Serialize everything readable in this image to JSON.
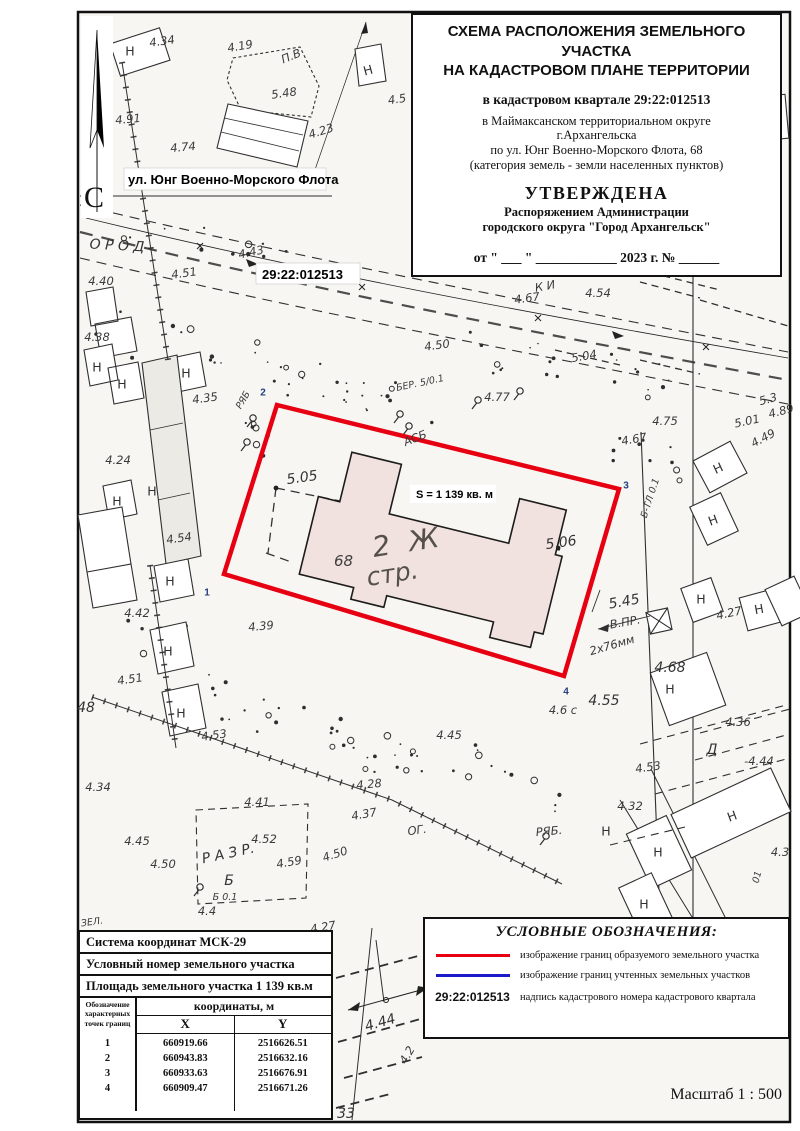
{
  "title_block": {
    "head1": "СХЕМА РАСПОЛОЖЕНИЯ ЗЕМЕЛЬНОГО УЧАСТКА",
    "head2": "НА КАДАСТРОВОМ ПЛАНЕ ТЕРРИТОРИИ",
    "quarter": "в кадастровом квартале 29:22:012513",
    "addr1": "в Маймаксанском территориальном округе",
    "addr2": "г.Архангельска",
    "addr3": "по ул. Юнг Военно-Морского Флота, 68",
    "addr4": "(категория земель - земли населенных пунктов)",
    "approved": "УТВЕРЖДЕНА",
    "admin1": "Распоряжением Администрации",
    "admin2": "городского округа \"Город Архангельск\"",
    "date_line": "от \" ___ \" ____________ 2023 г. № ______"
  },
  "map": {
    "north_label": "С",
    "street_label": "ул. Юнг Военно-Морского Флота",
    "quarter_label": "29:22:012513",
    "area_label": "S = 1 139 кв. м",
    "building_label_line1": "2 Ж",
    "building_label_line2": "стр.",
    "building_number": "68",
    "colors": {
      "parcel_formed": "#e60012",
      "building_fill": "#f1e2df"
    },
    "labels": [
      {
        "t": "Н",
        "x": 130,
        "y": 51,
        "c": "n"
      },
      {
        "t": "4.34",
        "x": 162,
        "y": 41,
        "r": -8
      },
      {
        "t": "4.19",
        "x": 240,
        "y": 46,
        "r": -10
      },
      {
        "t": "П.В",
        "x": 291,
        "y": 56,
        "r": -22
      },
      {
        "t": "5.48",
        "x": 284,
        "y": 93,
        "r": -8
      },
      {
        "t": "Н",
        "x": 368,
        "y": 70,
        "c": "n",
        "r": -15
      },
      {
        "t": "4.5",
        "x": 397,
        "y": 99,
        "r": -8
      },
      {
        "t": "4.91",
        "x": 128,
        "y": 119,
        "r": -5
      },
      {
        "t": "4.74",
        "x": 183,
        "y": 147,
        "r": -5
      },
      {
        "t": "4.23",
        "x": 321,
        "y": 131,
        "r": -18
      },
      {
        "t": "О Р О Д",
        "x": 117,
        "y": 245,
        "c": "hw2",
        "r": 3
      },
      {
        "t": "4.43",
        "x": 251,
        "y": 252,
        "r": -12
      },
      {
        "t": "4.51",
        "x": 184,
        "y": 273,
        "r": -8
      },
      {
        "t": "4.40",
        "x": 101,
        "y": 281
      },
      {
        "t": "4.67",
        "x": 527,
        "y": 298,
        "r": -8
      },
      {
        "t": "К И",
        "x": 545,
        "y": 286,
        "r": -10
      },
      {
        "t": "4.54",
        "x": 598,
        "y": 293
      },
      {
        "t": "4.38",
        "x": 97,
        "y": 337
      },
      {
        "t": "4.50",
        "x": 437,
        "y": 345,
        "r": -8
      },
      {
        "t": "5.04",
        "x": 584,
        "y": 356,
        "r": -10
      },
      {
        "t": "БЕР. 5/0.1",
        "x": 420,
        "y": 383,
        "r": -12,
        "c": "sm"
      },
      {
        "t": "4.35",
        "x": 205,
        "y": 398,
        "r": -8
      },
      {
        "t": "РЯБ",
        "x": 243,
        "y": 400,
        "c": "sm",
        "r": -60
      },
      {
        "t": "4.77",
        "x": 497,
        "y": 397
      },
      {
        "t": "АСБ",
        "x": 415,
        "y": 438,
        "r": -22
      },
      {
        "t": "4.75",
        "x": 665,
        "y": 421
      },
      {
        "t": "4.67",
        "x": 634,
        "y": 439,
        "r": -10
      },
      {
        "t": "5.01",
        "x": 747,
        "y": 421,
        "r": -12
      },
      {
        "t": "4.49",
        "x": 763,
        "y": 438,
        "r": -28
      },
      {
        "t": "5.3",
        "x": 768,
        "y": 399,
        "r": -15
      },
      {
        "t": "4.89",
        "x": 781,
        "y": 411,
        "r": -15
      },
      {
        "t": "4.24",
        "x": 118,
        "y": 460
      },
      {
        "t": "Н",
        "x": 97,
        "y": 367,
        "c": "n"
      },
      {
        "t": "Н",
        "x": 122,
        "y": 384,
        "c": "n"
      },
      {
        "t": "Н",
        "x": 186,
        "y": 373,
        "c": "n"
      },
      {
        "t": "Б-ТЛ 0.1",
        "x": 650,
        "y": 498,
        "r": -72,
        "c": "sm"
      },
      {
        "t": "Н",
        "x": 718,
        "y": 468,
        "c": "n",
        "r": -25
      },
      {
        "t": "Н",
        "x": 713,
        "y": 520,
        "c": "n",
        "r": -20
      },
      {
        "t": "5.05",
        "x": 302,
        "y": 477,
        "c": "hw2",
        "r": -8
      },
      {
        "t": "5.06",
        "x": 561,
        "y": 542,
        "c": "hw2",
        "r": -8
      },
      {
        "t": "Н",
        "x": 152,
        "y": 491,
        "c": "n"
      },
      {
        "t": "Н",
        "x": 117,
        "y": 501,
        "c": "n"
      },
      {
        "t": "4.54",
        "x": 179,
        "y": 538,
        "r": -8
      },
      {
        "t": "4.42",
        "x": 137,
        "y": 613
      },
      {
        "t": "4.39",
        "x": 261,
        "y": 626,
        "r": -5
      },
      {
        "t": "Н",
        "x": 170,
        "y": 581,
        "c": "n"
      },
      {
        "t": "Н",
        "x": 168,
        "y": 651,
        "c": "n"
      },
      {
        "t": "4.51",
        "x": 130,
        "y": 679,
        "r": -8
      },
      {
        "t": "48",
        "x": 86,
        "y": 707,
        "c": "hw2"
      },
      {
        "t": "Н",
        "x": 181,
        "y": 713,
        "c": "n"
      },
      {
        "t": "4.53",
        "x": 214,
        "y": 735,
        "r": -8
      },
      {
        "t": "5.45",
        "x": 624,
        "y": 601,
        "c": "hw2",
        "r": -10
      },
      {
        "t": "В.ПР.",
        "x": 625,
        "y": 622,
        "r": -10
      },
      {
        "t": "2х76мм",
        "x": 612,
        "y": 645,
        "r": -16
      },
      {
        "t": "4.68",
        "x": 670,
        "y": 667,
        "c": "hw2"
      },
      {
        "t": "4.27",
        "x": 729,
        "y": 613,
        "r": -12
      },
      {
        "t": "Н",
        "x": 701,
        "y": 599,
        "c": "n"
      },
      {
        "t": "Н",
        "x": 759,
        "y": 609,
        "c": "n",
        "r": -10
      },
      {
        "t": "Н",
        "x": 670,
        "y": 689,
        "c": "n"
      },
      {
        "t": "4.55",
        "x": 604,
        "y": 700,
        "c": "hw2"
      },
      {
        "t": "4.6 с",
        "x": 563,
        "y": 710
      },
      {
        "t": "4.45",
        "x": 449,
        "y": 735
      },
      {
        "t": "4.36",
        "x": 738,
        "y": 722
      },
      {
        "t": "Д",
        "x": 712,
        "y": 749,
        "c": "hw2"
      },
      {
        "t": "-4.44",
        "x": 759,
        "y": 761
      },
      {
        "t": "4.53",
        "x": 648,
        "y": 767,
        "r": -8
      },
      {
        "t": "4.32",
        "x": 630,
        "y": 806
      },
      {
        "t": "4.28",
        "x": 369,
        "y": 784,
        "r": -5
      },
      {
        "t": "4.37",
        "x": 364,
        "y": 814,
        "r": -10
      },
      {
        "t": "4.41",
        "x": 257,
        "y": 802
      },
      {
        "t": "4.34",
        "x": 98,
        "y": 787
      },
      {
        "t": "ОГ.",
        "x": 417,
        "y": 830,
        "r": -8
      },
      {
        "t": "РЯБ.",
        "x": 549,
        "y": 831,
        "r": -5
      },
      {
        "t": "Н",
        "x": 606,
        "y": 831,
        "c": "n"
      },
      {
        "t": "Н",
        "x": 732,
        "y": 816,
        "c": "n",
        "r": -20
      },
      {
        "t": "Н",
        "x": 658,
        "y": 852,
        "c": "n"
      },
      {
        "t": "Н",
        "x": 644,
        "y": 904,
        "c": "n"
      },
      {
        "t": "01",
        "x": 757,
        "y": 877,
        "r": -75,
        "c": "sm"
      },
      {
        "t": "4.3",
        "x": 780,
        "y": 852
      },
      {
        "t": "4.45",
        "x": 137,
        "y": 841
      },
      {
        "t": "4.50",
        "x": 163,
        "y": 864
      },
      {
        "t": "Р А З Р.",
        "x": 228,
        "y": 853,
        "r": -12,
        "c": "hw2"
      },
      {
        "t": "4.52",
        "x": 264,
        "y": 839
      },
      {
        "t": "4.59",
        "x": 289,
        "y": 862,
        "r": -10
      },
      {
        "t": "Б",
        "x": 229,
        "y": 880,
        "c": "hw2"
      },
      {
        "t": "Б 0.1",
        "x": 225,
        "y": 897,
        "c": "sm"
      },
      {
        "t": "4.4",
        "x": 207,
        "y": 911
      },
      {
        "t": "4.50",
        "x": 335,
        "y": 854,
        "r": -18
      },
      {
        "t": "ЗЕЛ.",
        "x": 92,
        "y": 922,
        "r": -8,
        "c": "sm"
      },
      {
        "t": "4.27",
        "x": 323,
        "y": 927,
        "r": -10
      },
      {
        "t": "4.44",
        "x": 380,
        "y": 1022,
        "r": -16,
        "c": "hw2"
      },
      {
        "t": "4.2",
        "x": 407,
        "y": 1055,
        "r": -60
      },
      {
        "t": "33",
        "x": 346,
        "y": 1113,
        "c": "hw2"
      },
      {
        "t": "1",
        "x": 207,
        "y": 592,
        "c": "num"
      },
      {
        "t": "2",
        "x": 263,
        "y": 392,
        "c": "num"
      },
      {
        "t": "3",
        "x": 626,
        "y": 485,
        "c": "num"
      },
      {
        "t": "4",
        "x": 566,
        "y": 691,
        "c": "num"
      }
    ]
  },
  "coord_table": {
    "row1": "Система координат МСК-29",
    "row2": "Условный номер земельного участка",
    "row3": "Площадь земельного участка 1 139 кв.м",
    "col_point1": "Обозначение",
    "col_point2": "характерных",
    "col_point3": "точек границ",
    "col_coords": "координаты, м",
    "col_x": "X",
    "col_y": "Y",
    "points": [
      {
        "n": "1",
        "x": "660919.66",
        "y": "2516626.51"
      },
      {
        "n": "2",
        "x": "660943.83",
        "y": "2516632.16"
      },
      {
        "n": "3",
        "x": "660933.63",
        "y": "2516676.91"
      },
      {
        "n": "4",
        "x": "660909.47",
        "y": "2516671.26"
      }
    ]
  },
  "legend": {
    "title": "УСЛОВНЫЕ ОБОЗНАЧЕНИЯ:",
    "colors": {
      "formed": "#e60012",
      "recorded": "#1a1ac8"
    },
    "items": [
      {
        "type": "red-line",
        "text": "изображение границ образуемого земельного участка"
      },
      {
        "type": "blue-line",
        "text": "изображение границ учтенных земельных участков"
      },
      {
        "type": "code",
        "symbol": "29:22:012513",
        "text": "надпись кадастрового номера кадастрового квартала"
      }
    ]
  },
  "scale_label": "Масштаб  1 : 500"
}
